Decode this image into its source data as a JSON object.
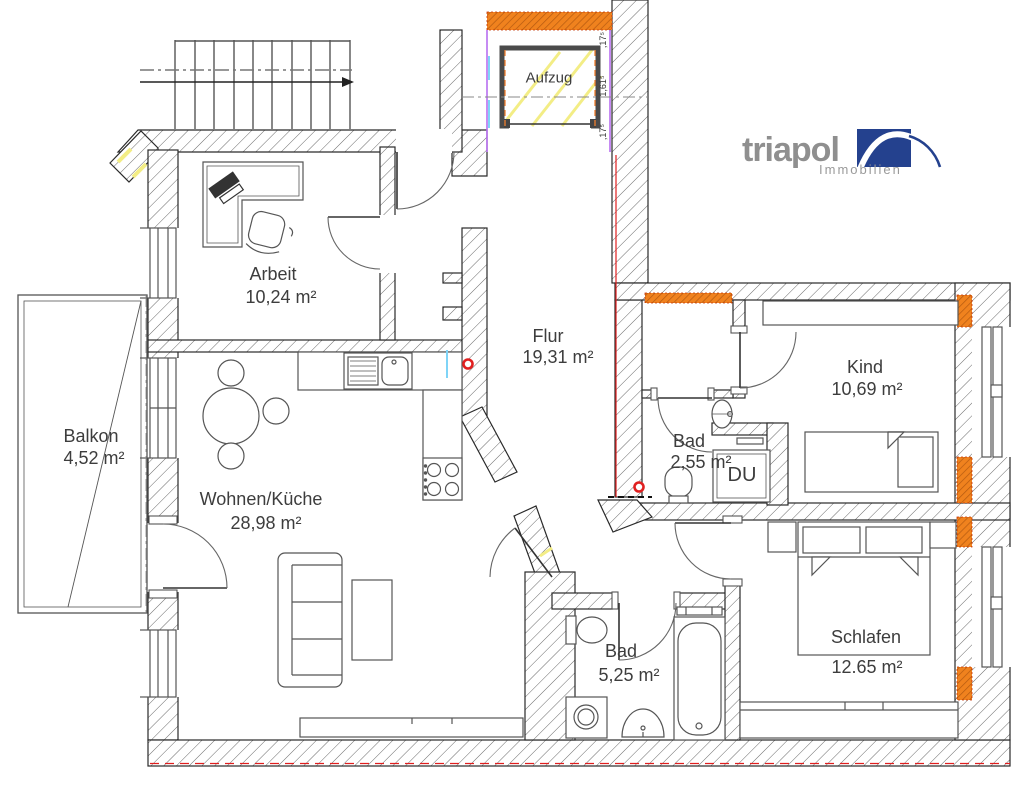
{
  "logo": {
    "brand": "triapol",
    "tagline": "Immobilien"
  },
  "labels": {
    "elevator": "Aufzug",
    "shower": "DU"
  },
  "rooms": {
    "arbeit": {
      "name": "Arbeit",
      "area": "10,24 m²"
    },
    "flur": {
      "name": "Flur",
      "area": "19,31 m²"
    },
    "kind": {
      "name": "Kind",
      "area": "10,69 m²"
    },
    "bad_klein": {
      "name": "Bad",
      "area": "2,55 m²"
    },
    "wohnen_kueche": {
      "name": "Wohnen/Küche",
      "area": "28,98 m²"
    },
    "balkon": {
      "name": "Balkon",
      "area": "4,52 m²"
    },
    "bad_gross": {
      "name": "Bad",
      "area": "5,25 m²"
    },
    "schlafen": {
      "name": "Schlafen",
      "area": "12.65 m²"
    }
  },
  "dimensions": {
    "wall_top": ",17⁵",
    "shaft_height": "1,61⁵",
    "wall_bottom": ",17⁵"
  },
  "colors": {
    "logo_blue": "#24418e",
    "logo_gray": "#8f8f8f",
    "window_orange": "#f0821e",
    "marker_red": "#e02020",
    "shaft_yellow": "#f3ed85",
    "wall_line": "#4a4a4a"
  }
}
